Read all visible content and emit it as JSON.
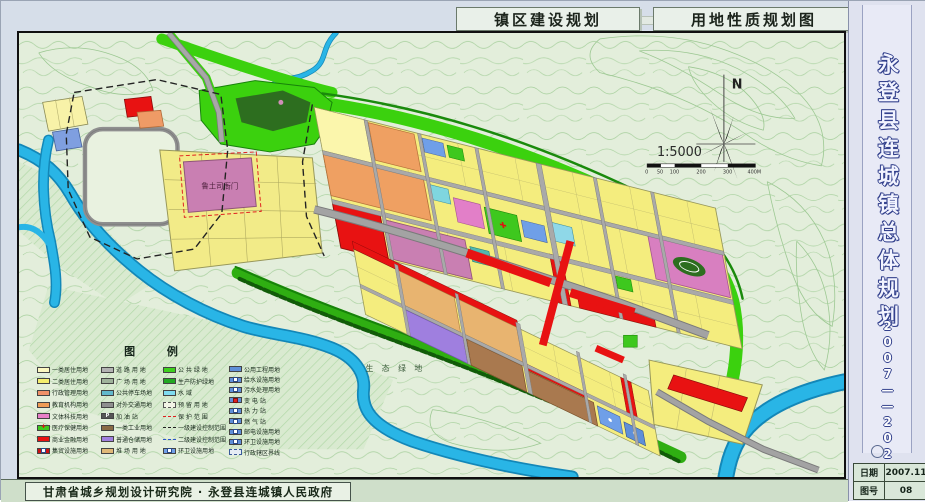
{
  "header": {
    "title_left": "镇区建设规划",
    "title_right": "用地性质规划图"
  },
  "sidebar": {
    "title": "永登县连城镇总体规划",
    "years": "2007——2020",
    "meta": [
      {
        "label": "日期",
        "value": "2007.11"
      },
      {
        "label": "图号",
        "value": "08"
      }
    ]
  },
  "footer": {
    "credit": "甘肃省城乡规划设计研究院 · 永登县连城镇人民政府"
  },
  "map": {
    "north_label": "N",
    "scale_text": "1:5000",
    "scale_ticks": [
      "0",
      "50",
      "100",
      "200",
      "300",
      "400M"
    ],
    "labels": {
      "heritage": "鲁土司衙门",
      "eco": "生 态 绿 地"
    },
    "colors": {
      "water": "#29b5e6",
      "green_band": "#3bd10e",
      "residential": "#f4ed7e",
      "commercial_red": "#e81212",
      "road_gray": "#a8a8a8"
    }
  },
  "legend": {
    "title": "图 例",
    "columns": [
      {
        "items": [
          {
            "label": "一类居住用地",
            "color": "#fcf8c0"
          },
          {
            "label": "二类居住用地",
            "color": "#f5ee6e"
          },
          {
            "label": "行政管理用地",
            "color": "#f09068"
          },
          {
            "label": "教育机构用地",
            "color": "#ef9b55"
          },
          {
            "label": "文体科技用地",
            "color": "#e87fc8"
          },
          {
            "label": "医疗保健用地",
            "color": "#3ec81e",
            "kind": "cross",
            "glyph": "✚"
          },
          {
            "label": "商业金融用地",
            "color": "#e81212"
          },
          {
            "label": "集贸设施用地",
            "color": "#cc1212",
            "kind": "dot"
          }
        ]
      },
      {
        "items": [
          {
            "label": "道 路 用 地",
            "color": "#b3b3b3"
          },
          {
            "label": "广 场 用 地",
            "color": "#9fb39b"
          },
          {
            "label": "公共停车场地",
            "color": "#62b8cc"
          },
          {
            "label": "对外交通用地",
            "color": "#8f8f8f"
          },
          {
            "label": "加  油  站",
            "color": "#555555",
            "kind": "p",
            "glyph": "P"
          },
          {
            "label": "一类工业用地",
            "color": "#8a6a45"
          },
          {
            "label": "普通仓储用地",
            "color": "#9f7fdf"
          },
          {
            "label": "堆 场 用 地",
            "color": "#e0b878"
          }
        ]
      },
      {
        "items": [
          {
            "label": "公 共 绿 地",
            "color": "#3ed01e"
          },
          {
            "label": "生产防护绿地",
            "color": "#22a822",
            "kind": "hatch"
          },
          {
            "label": "水        域",
            "color": "#7fdcf0"
          },
          {
            "label": "预 留 用 地",
            "kind": "outline-dash"
          },
          {
            "label": "保 护 范 围",
            "kind": "line-red"
          },
          {
            "label": "一级建设控制范围",
            "kind": "line-black"
          },
          {
            "label": "二级建设控制范围",
            "kind": "line-blue"
          },
          {
            "label": "环卫设施用地",
            "color": "#6f9fe8",
            "kind": "dot"
          }
        ]
      },
      {
        "items": [
          {
            "label": "公用工程用地",
            "color": "#5f8fd8"
          },
          {
            "label": "给水设施用地",
            "color": "#5f8fd8",
            "kind": "dot"
          },
          {
            "label": "污水处理用地",
            "color": "#5f8fd8",
            "kind": "dot"
          },
          {
            "label": "变  电  站",
            "color": "#5f8fd8",
            "kind": "dot-red"
          },
          {
            "label": "热  力  站",
            "color": "#5f8fd8",
            "kind": "dot"
          },
          {
            "label": "燃  气  站",
            "color": "#5f8fd8",
            "kind": "dot"
          },
          {
            "label": "邮电设施用地",
            "color": "#5f8fd8",
            "kind": "dot"
          },
          {
            "label": "环卫设施用地",
            "color": "#5f8fd8",
            "kind": "dot"
          },
          {
            "label": "行政辖区界线",
            "kind": "outline-dash2"
          }
        ]
      }
    ]
  }
}
